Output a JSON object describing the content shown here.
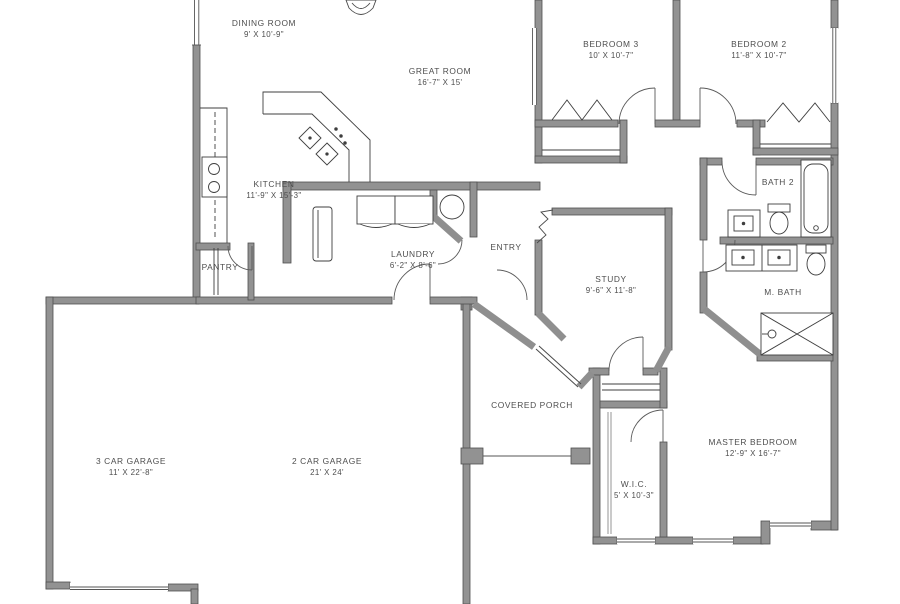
{
  "drawing": {
    "type": "residential-floor-plan"
  },
  "rooms": [
    {
      "id": "dining",
      "name": "DINING ROOM",
      "dims": "9' X 10'-9\""
    },
    {
      "id": "great",
      "name": "GREAT ROOM",
      "dims": "16'-7\" X 15'"
    },
    {
      "id": "bed3",
      "name": "BEDROOM 3",
      "dims": "10' X 10'-7\""
    },
    {
      "id": "bed2",
      "name": "BEDROOM 2",
      "dims": "11'-8\" X 10'-7\""
    },
    {
      "id": "kitchen",
      "name": "KITCHEN",
      "dims": "11'-9\" X 15'-3\""
    },
    {
      "id": "bath2",
      "name": "BATH 2",
      "dims": ""
    },
    {
      "id": "laundry",
      "name": "LAUNDRY",
      "dims": "6'-2\" X 8'-6\""
    },
    {
      "id": "entry",
      "name": "ENTRY",
      "dims": ""
    },
    {
      "id": "pantry",
      "name": "PANTRY",
      "dims": ""
    },
    {
      "id": "study",
      "name": "STUDY",
      "dims": "9'-6\" X 11'-8\""
    },
    {
      "id": "mbath",
      "name": "M. BATH",
      "dims": ""
    },
    {
      "id": "porch",
      "name": "COVERED PORCH",
      "dims": ""
    },
    {
      "id": "garage3",
      "name": "3 CAR GARAGE",
      "dims": "11' X 22'-8\""
    },
    {
      "id": "garage2",
      "name": "2 CAR GARAGE",
      "dims": "21' X 24'"
    },
    {
      "id": "master",
      "name": "MASTER BEDROOM",
      "dims": "12'-9\" X 16'-7\""
    },
    {
      "id": "wic",
      "name": "W.I.C.",
      "dims": "5' X 10'-3\""
    }
  ],
  "colors": {
    "wall_fill": "#929292",
    "wall_edge": "#4f4f4f",
    "fixture_line": "#3f3f3f",
    "label_text": "#4e4e4e",
    "background": "#ffffff"
  }
}
